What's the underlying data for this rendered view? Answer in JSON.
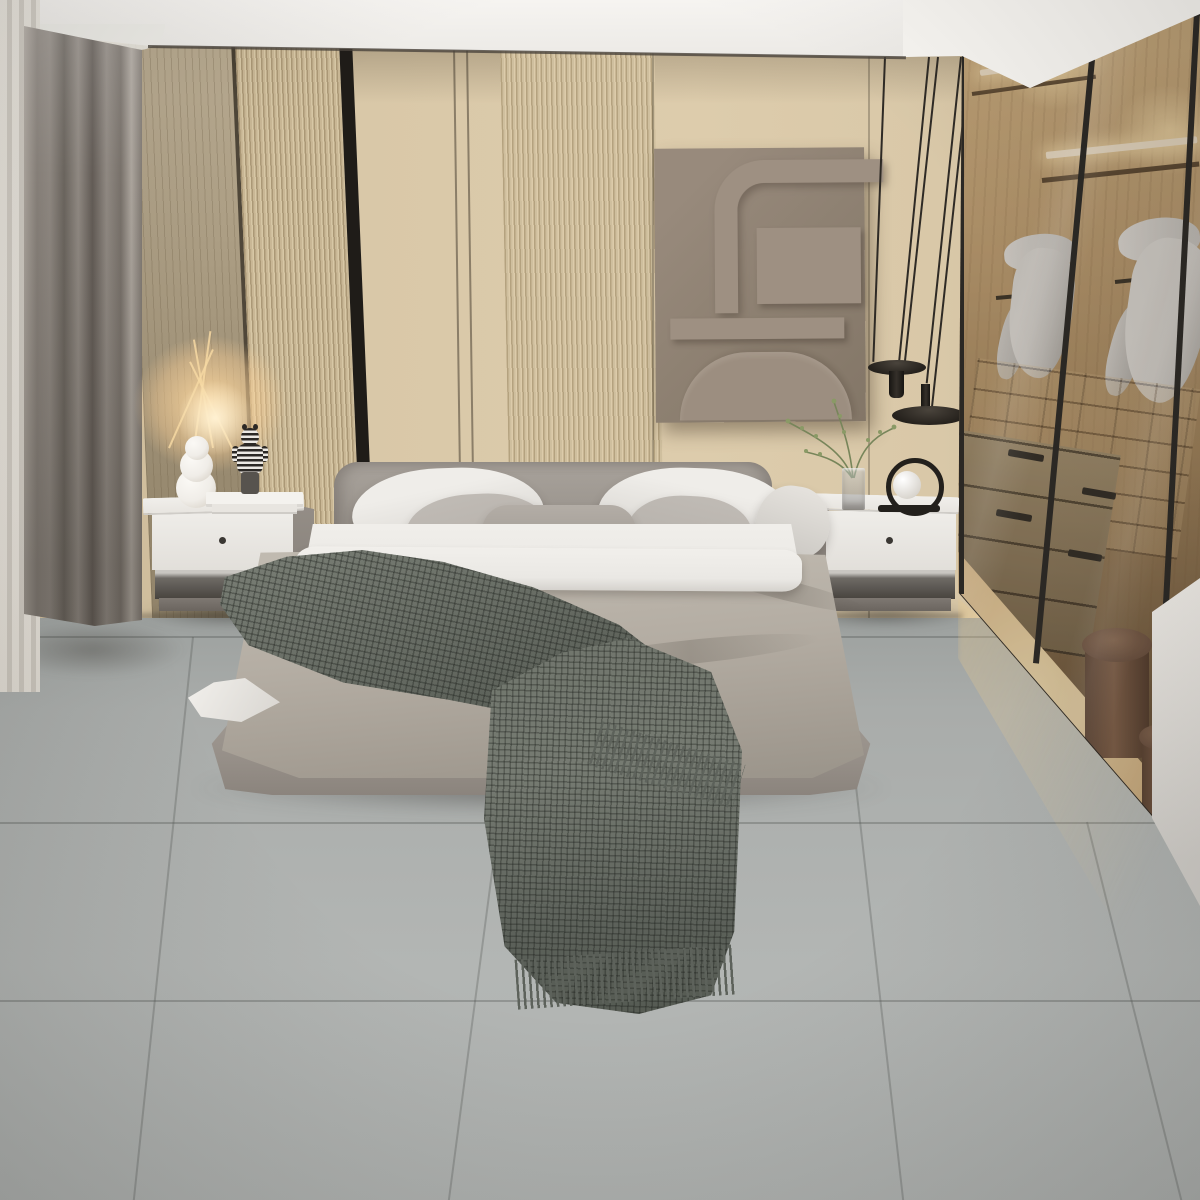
{
  "scene": {
    "description": "3D interior render of a modern minimalist bedroom: wood slat and beige panelled accent wall, gray upholstered double bed with layered pillows, taupe duvet and dark waffle throw, two white nightstands with decor (bubble vase with lit dried flowers, striped bear figurine, books, green branch vase, ring sphere lamp), black two-disc pendant lamp, abstract relief wall art, gray curtains, glass-walled illuminated walk-in wardrobe with hanging jackets, drawers and round wooden boxes, large gray tile floor."
  },
  "objects": [
    "ceiling-cove",
    "accent-wall-panels",
    "sheer-curtain",
    "gray-drapes",
    "wall-art-relief",
    "pendant-lamp",
    "bed",
    "headboard",
    "pillows",
    "duvet",
    "throw-blanket",
    "nightstand-left",
    "nightstand-right",
    "bubble-vase",
    "dried-flowers",
    "bear-figurine",
    "books",
    "branch-vase",
    "ring-lamp",
    "walk-in-closet",
    "hanging-jackets",
    "closet-drawers",
    "closet-cubbies",
    "round-boxes",
    "tile-floor"
  ],
  "palette": {
    "ceiling1": "#f6f4f1",
    "ceiling2": "#dcd8d3",
    "soffit": "#f7f5f1",
    "groove": "#4a443c",
    "wall1": "#d9c8a8",
    "wall2": "#cbb997",
    "wallShadow": "rgba(74,62,44,0.28)",
    "woodA1": "#b7a98f",
    "woodA2": "#94866c",
    "grain": "rgba(110,95,70,0.28)",
    "rib1": "#c9b795",
    "rib1d": "#ab9876",
    "rib1l": "#d7c7a5",
    "rib2": "#cfbf9e",
    "rib2d": "#b4a27f",
    "rib2l": "#dccbaa",
    "blackStripe": "#1f1c18",
    "artBg1": "#988a7c",
    "artBg2": "#837667",
    "artPiece": "#9e9082",
    "curtS1": "#f3f1ed",
    "curtS2": "#dbd8d3",
    "drape1": "#b1aaa2",
    "drape2": "#6f6962",
    "drape3": "#958e87",
    "cable": "#2e2a25",
    "pendant": "#26221d",
    "glass": "rgba(59,49,40,0.20)",
    "frame": "#2b2824",
    "cwood1": "#d9b886",
    "cwood2": "#a8895f",
    "cwood3": "#6e573c",
    "led": "#fff1d8",
    "ledGlow": "rgba(255,228,175,0.85)",
    "jacket1": "#e2dfda",
    "jacket2": "#aeaba6",
    "cubLine": "rgba(40,25,12,0.35)",
    "cubFill": "rgba(214,184,138,0.30)",
    "drw1": "#a3906f",
    "drw2": "#7a684c",
    "drwSeam": "rgba(25,18,10,0.55)",
    "handle": "#2e2a24",
    "litFloor1": "#f7e3b6",
    "litFloor2": "#e2c08d",
    "box1": "#86644c",
    "box2": "#5f4534",
    "boxLid": "#8f6e55",
    "cap1": "#eae7e2",
    "cap2": "#d0cdc8",
    "floor1": "#9da19f",
    "floor2": "#a9acaa",
    "floor3": "#b3b6b4",
    "seam": "rgba(80,82,80,0.6)",
    "hb1": "#a8a29b",
    "hb2": "#8f8982",
    "base1": "#b2aca5",
    "base2": "#8b847d",
    "pillowW1": "#efede9",
    "pillowW2": "#d2cfca",
    "pillowG": "#b9b4ae",
    "lumbar": "#a7a19a",
    "sheet": "#eae8e4",
    "duv1": "#c0bab0",
    "duv2": "#a39c92",
    "throw1": "#767b72",
    "throw2": "#555a52",
    "waffle": "rgba(25,28,24,0.32), ",
    "fringe": "#5d625b",
    "nsWhite1": "#f1efeb",
    "nsWhite2": "#e2dfda",
    "nsSide": "#8b857e",
    "nsShelfTop": "#c9c6c1",
    "nsShelfDark": "#47433e",
    "plinth": "#7e7872",
    "knob": "#3a3733",
    "vaseWhite": "#f0ede8",
    "glowWarm": "rgba(255,218,160,0.9)",
    "stripeDark": "#2b2825",
    "figLeg": "#57534e",
    "bookTop": "#f4f2ee",
    "bookEdge": "#dbd8d3",
    "plantStem": "#77855a",
    "plantLeaf": "#8a9a66",
    "vaseGlass1": "rgba(205,210,214,0.45)",
    "vaseGlass2": "rgba(140,138,135,0.6)",
    "lamp": "#23201c",
    "sphere1": "#ffffff",
    "sphere2": "#d8d4cd",
    "shadow": "rgba(35,33,30,0.45)",
    "spill": "rgba(242,206,140,0.30)",
    "vign": "rgba(30,28,25,0.16)"
  }
}
